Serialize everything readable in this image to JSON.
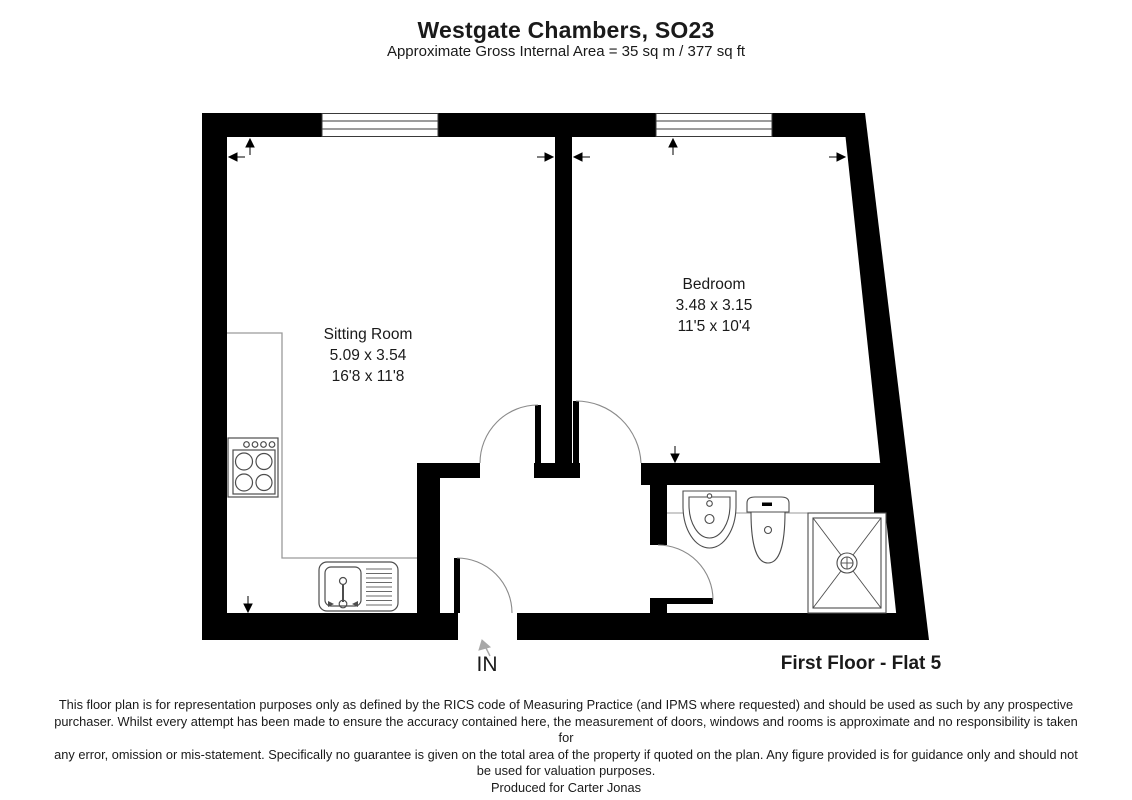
{
  "header": {
    "title": "Westgate Chambers, SO23",
    "subtitle": "Approximate Gross Internal Area = 35 sq m / 377 sq ft"
  },
  "rooms": {
    "sitting_room": {
      "name": "Sitting Room",
      "size_metric": "5.09 x 3.54",
      "size_imperial": "16'8 x 11'8"
    },
    "bedroom": {
      "name": "Bedroom",
      "size_metric": "3.48 x 3.15",
      "size_imperial": "11'5 x 10'4"
    }
  },
  "labels": {
    "entrance": "IN",
    "floor": "First Floor - Flat 5"
  },
  "disclaimer": {
    "lines": [
      "This floor plan is for representation purposes only as defined by the RICS code of Measuring Practice (and IPMS where requested) and should be used as such by any prospective",
      "purchaser. Whilst every attempt has been made to ensure the accuracy contained here, the measurement of doors, windows and rooms is approximate and no responsibility is taken for",
      "any error, omission or mis-statement. Specifically no guarantee is given on the total area of the property if quoted on the plan. Any figure provided is for guidance only and should not",
      "be used for valuation purposes.",
      "Produced for Carter Jonas"
    ]
  },
  "icons": {
    "fixtures": [
      "hob-icon",
      "kitchen-sink-icon",
      "basin-icon",
      "toilet-icon",
      "shower-icon",
      "window-icon",
      "door-arc-icon",
      "dimension-arrow-icon",
      "entrance-arrow-icon"
    ]
  },
  "colors": {
    "wall": "#000000",
    "fixture_outline": "#4d4d4d",
    "counter_line": "#9a9a9a",
    "door_arc": "#8a8a8a",
    "text": "#1a1a1a"
  }
}
